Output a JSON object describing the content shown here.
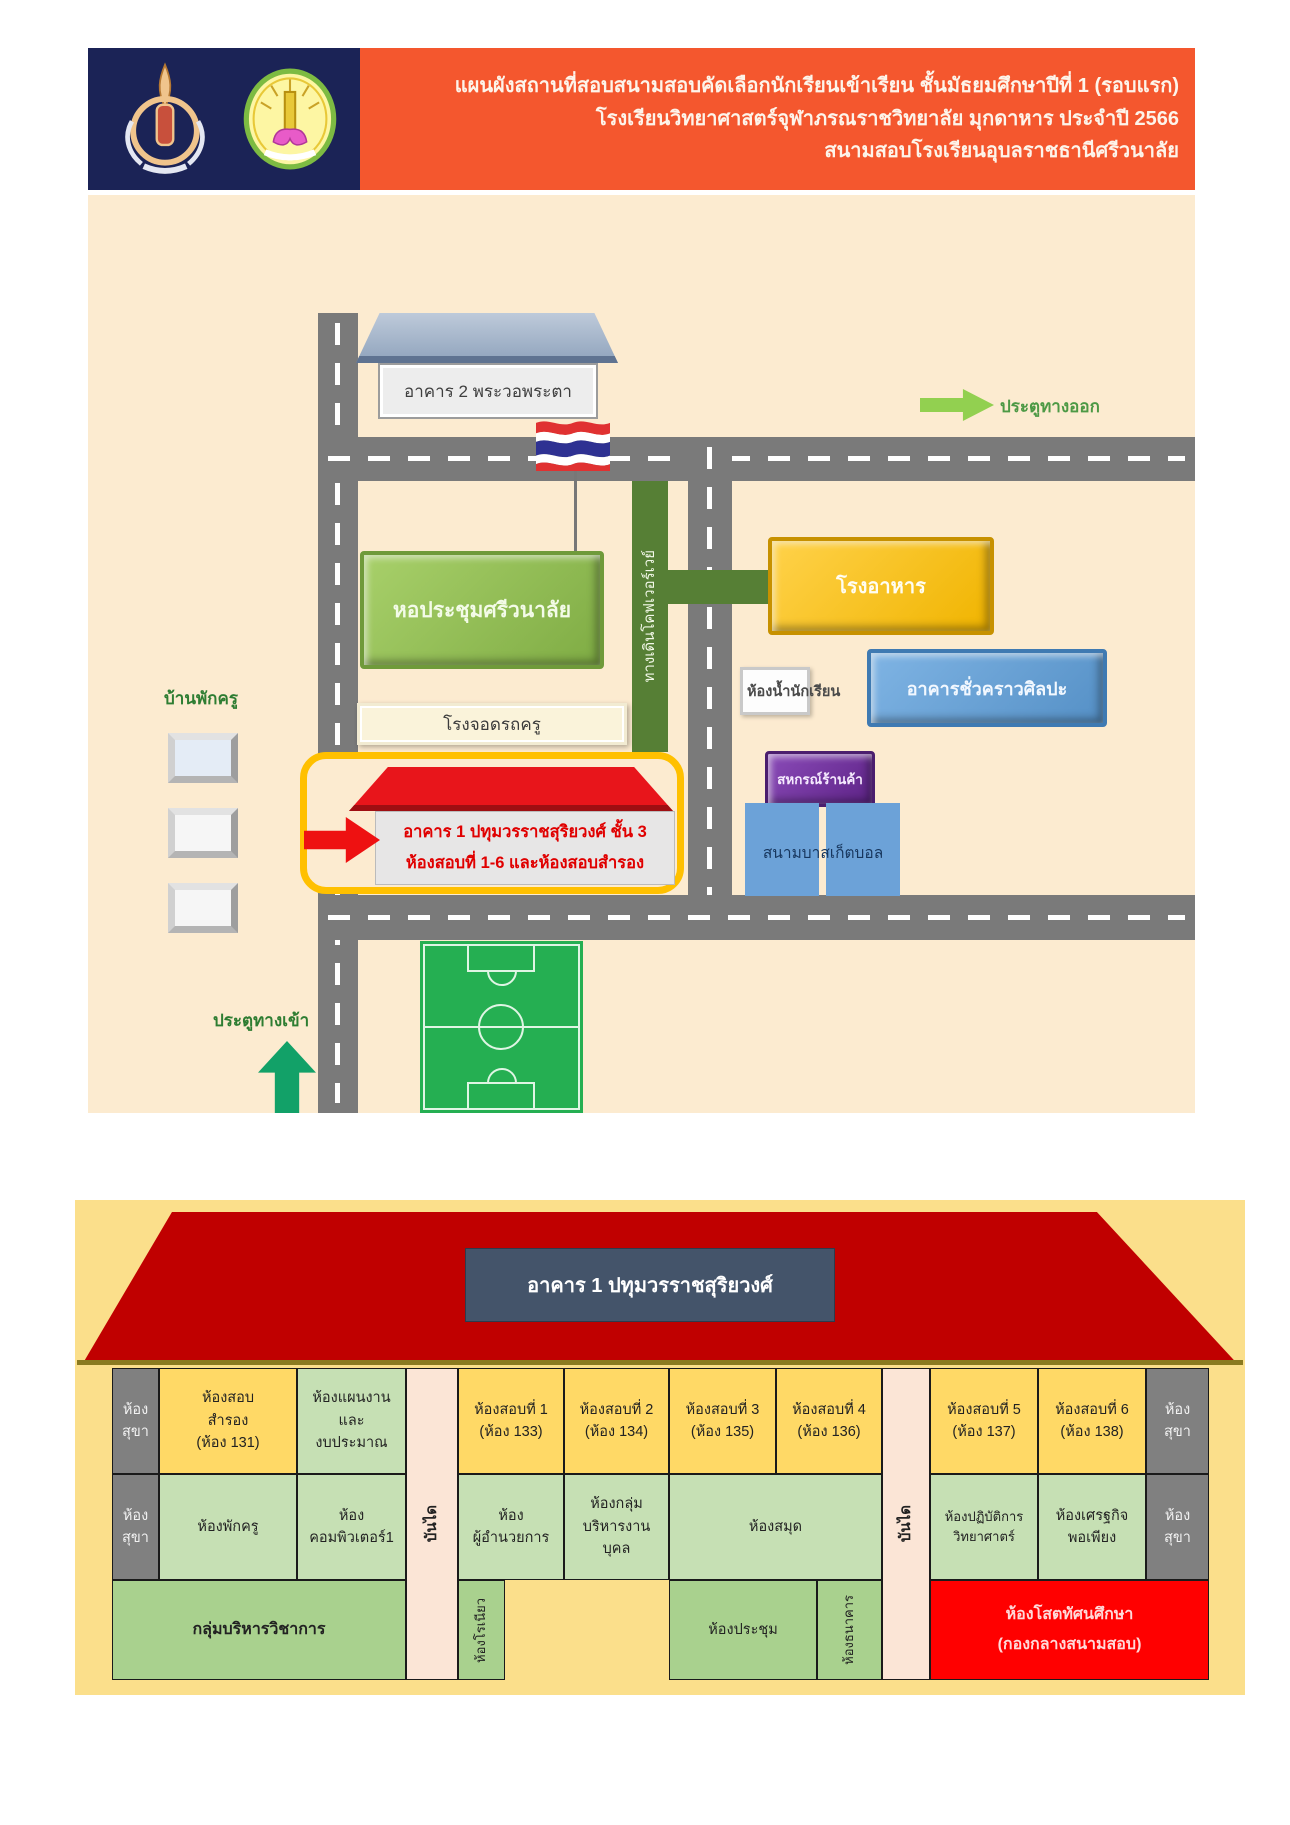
{
  "header": {
    "line1": "แผนผังสถานที่สอบสนามสอบคัดเลือกนักเรียนเข้าเรียน ชั้นมัธยมศึกษาปีที่ 1  (รอบแรก)",
    "line2": "โรงเรียนวิทยาศาสตร์จุฬาภรณราชวิทยาลัย มุกดาหาร ประจำปี 2566",
    "line3": "สนามสอบโรงเรียนอุบลราชธานีศรีวนาลัย"
  },
  "map": {
    "building2_label": "อาคาร 2 พระวอพระตา",
    "exit_gate_label": "ประตูทางออก",
    "entrance_gate_label": "ประตูทางเข้า",
    "auditorium_label": "หอประชุมศรีวนาลัย",
    "canteen_label": "โรงอาหาร",
    "walkway_label": "ทางเดินโคฟเวอร์เวย์",
    "student_toilet_label": "ห้องน้ำนักเรียน",
    "art_building_label": "อาคารชั่วคราวศิลปะ",
    "parking_label": "โรงจอดรถครู",
    "coop_label": "สหกรณ์ร้านค้า",
    "basketball_label": "สนามบาสเก็ตบอล",
    "teacher_housing_label": "บ้านพักครู",
    "building1_line1": "อาคาร 1 ปทุมวรราชสุริยวงศ์ ชั้น 3",
    "building1_line2": "ห้องสอบที่ 1-6 และห้องสอบสำรอง"
  },
  "floorplan": {
    "title": "อาคาร 1 ปทุมวรราชสุริยวงศ์",
    "stairs_label": "บันได",
    "row1": {
      "toilet": {
        "l1": "ห้อง",
        "l2": "สุขา"
      },
      "reserve": {
        "l1": "ห้องสอบ",
        "l2": "สำรอง",
        "l3": "(ห้อง 131)"
      },
      "planning": {
        "l1": "ห้องแผนงาน",
        "l2": "และ",
        "l3": "งบประมาณ"
      },
      "exam1": {
        "l1": "ห้องสอบที่ 1",
        "l2": "(ห้อง 133)"
      },
      "exam2": {
        "l1": "ห้องสอบที่ 2",
        "l2": "(ห้อง 134)"
      },
      "exam3": {
        "l1": "ห้องสอบที่ 3",
        "l2": "(ห้อง 135)"
      },
      "exam4": {
        "l1": "ห้องสอบที่ 4",
        "l2": "(ห้อง 136)"
      },
      "exam5": {
        "l1": "ห้องสอบที่ 5",
        "l2": "(ห้อง 137)"
      },
      "exam6": {
        "l1": "ห้องสอบที่ 6",
        "l2": "(ห้อง 138)"
      }
    },
    "row2": {
      "toilet": {
        "l1": "ห้อง",
        "l2": "สุขา"
      },
      "teacher_lounge": "ห้องพักครู",
      "computer": {
        "l1": "ห้อง",
        "l2": "คอมพิวเตอร์1"
      },
      "director": {
        "l1": "ห้อง",
        "l2": "ผู้อำนวยการ"
      },
      "personnel": {
        "l1": "ห้องกลุ่ม",
        "l2": "บริหารงาน",
        "l3": "บุคล"
      },
      "library": "ห้องสมุด",
      "science": {
        "l1": "ห้องปฏิบัติการ",
        "l2": "วิทยาศาตร์"
      },
      "economy": {
        "l1": "ห้องเศรฐกิจ",
        "l2": "พอเพียง"
      }
    },
    "row3": {
      "academic": "กลุ่มบริหารวิชาการ",
      "roneo": "ห้องโรเนียว",
      "meeting": "ห้องประชุม",
      "bank": "ห้องธนาคาร",
      "av": {
        "l1": "ห้องโสตทัศนศึกษา",
        "l2": "(กองกลางสนามสอบ)"
      }
    }
  },
  "colors": {
    "header_navy": "#1B2356",
    "header_orange": "#F4572E",
    "map_cream": "#FCEBD0",
    "road_grey": "#7A7A7A",
    "panel_yellow": "#FBDF8B",
    "roof_red": "#C00000",
    "exam_yellow": "#FFD966",
    "room_green": "#C6E0B4",
    "room_green_dark": "#A9D18E",
    "toilet_grey": "#808080",
    "stair_pink": "#FBE5D6",
    "av_red": "#FF0000",
    "highlight_yellow": "#FFC000"
  }
}
